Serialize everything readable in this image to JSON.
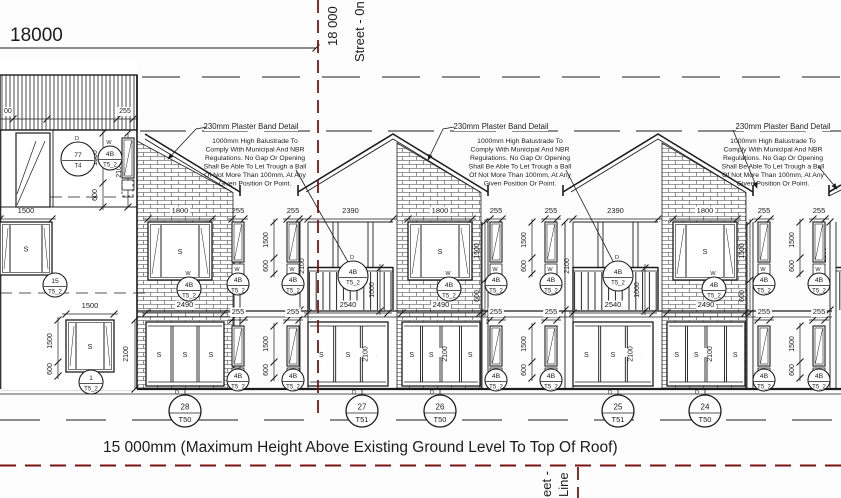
{
  "drawing": {
    "top_dimension": "18000",
    "street_line_top_dim": "18 000",
    "street_line_top_label": "Street - 0n",
    "street_line_bottom_partial": "eet -",
    "street_line_bottom_label": "Line",
    "max_height_note": "15 000mm (Maximum Height Above Existing Ground Level To Top Of Roof)"
  },
  "annotations": {
    "plaster_band": "230mm Plaster Band Detail",
    "balustrade_lines": [
      "1000mm High Balustrade To",
      "Comply With Municipal And NBR",
      "Regulations. No Gap Or Opening",
      "Shall Be Able To Let Trough a Ball",
      "Of Not More Than 100mm, At Any",
      "Given Position Or Point."
    ]
  },
  "dims": {
    "d18000": "18000",
    "d255": "255",
    "d1800": "1800",
    "d2390": "2390",
    "d2540": "2540",
    "d2490": "2490",
    "d1500": "1500",
    "d600": "600",
    "d2100": "2100",
    "d1000": "1000",
    "d00": "00"
  },
  "glass_mark": "S",
  "unit_mark": "D",
  "unit_labels": [
    {
      "no": "28",
      "type": "T50"
    },
    {
      "no": "27",
      "type": "T51"
    },
    {
      "no": "26",
      "type": "T50"
    },
    {
      "no": "25",
      "type": "T51"
    },
    {
      "no": "24",
      "type": "T50"
    }
  ],
  "opening_labels": {
    "door_left": {
      "mark": "D",
      "no": "77",
      "code": "T4"
    },
    "window_small": {
      "mark": "W",
      "no": "4B",
      "code": "T5_2"
    },
    "balcony_door": {
      "mark": "D",
      "no": "4B",
      "code": "T5_2"
    },
    "side_window_upper": {
      "no": "15",
      "code": "T5_2"
    },
    "side_window_lower": {
      "no": "1",
      "code": "T5_2"
    }
  },
  "colors": {
    "ink": "#1c1c1c",
    "construction": "#7a1414"
  }
}
